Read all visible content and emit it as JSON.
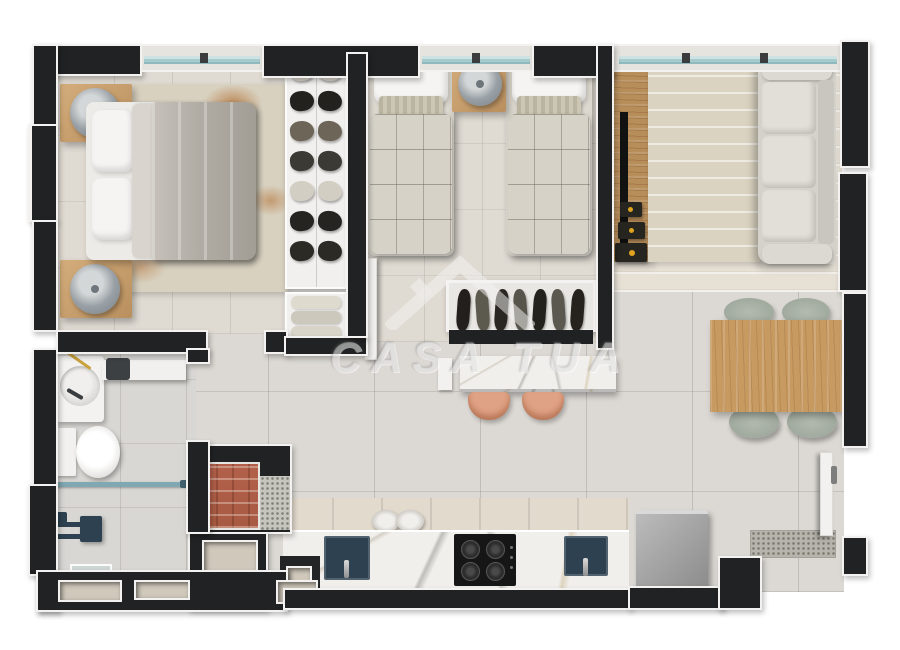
{
  "watermark": {
    "text": "CASA TUA"
  },
  "palette": {
    "wall": "#212223",
    "trim": "#f3f2f0",
    "floor_main": "#dcd9d4",
    "floor_bedroom": "#dfdad2",
    "floor_bath": "#d9d7d3",
    "window_glass": "#a6cbcf",
    "window_sill": "#e6e4df",
    "wood_nightstand": "#c7a06e",
    "wood_tv": "#b78d5a",
    "wood_table": "#c79a62",
    "marble": "#f1efec",
    "sofa_shell": "#d5d2cb",
    "sofa_cushion": "#e2dfd8",
    "bed_duvet": "#b4afa7",
    "bed_sheet": "#edebe7",
    "twin_quilt": "#d6d2c8",
    "stool": "#e0a284",
    "sink": "#2d4150",
    "cooktop": "#161616",
    "brick": "#b2604a",
    "chair": "#a9b1a5",
    "fridge": "#949494",
    "rug_bedroom": "#d8d1c0",
    "rug_living": "#dad3c1",
    "lamp": "#9aa1a6",
    "rust_accent": "#b5763c",
    "shower_glass": "#7fa8b2",
    "niche": "#cfc8bb"
  },
  "closet": {
    "upper_rows": [
      "#d7d3c8",
      "#23211d",
      "#6d6557",
      "#3b3a34",
      "#d2cec3",
      "#262420",
      "#2c2a25"
    ],
    "lower_rows": [
      "#dedace",
      "#ccc8bb",
      "#d8d4c8"
    ]
  },
  "wardrobe": {
    "item_colors": [
      "#221f1c",
      "#5c594f",
      "#2a2722",
      "#56544b",
      "#24221d",
      "#5b5850",
      "#26231e"
    ]
  },
  "kitchen": {
    "burner_count": 4
  },
  "island": {
    "stool_count": 2
  },
  "dining": {
    "chair_count": 4
  }
}
